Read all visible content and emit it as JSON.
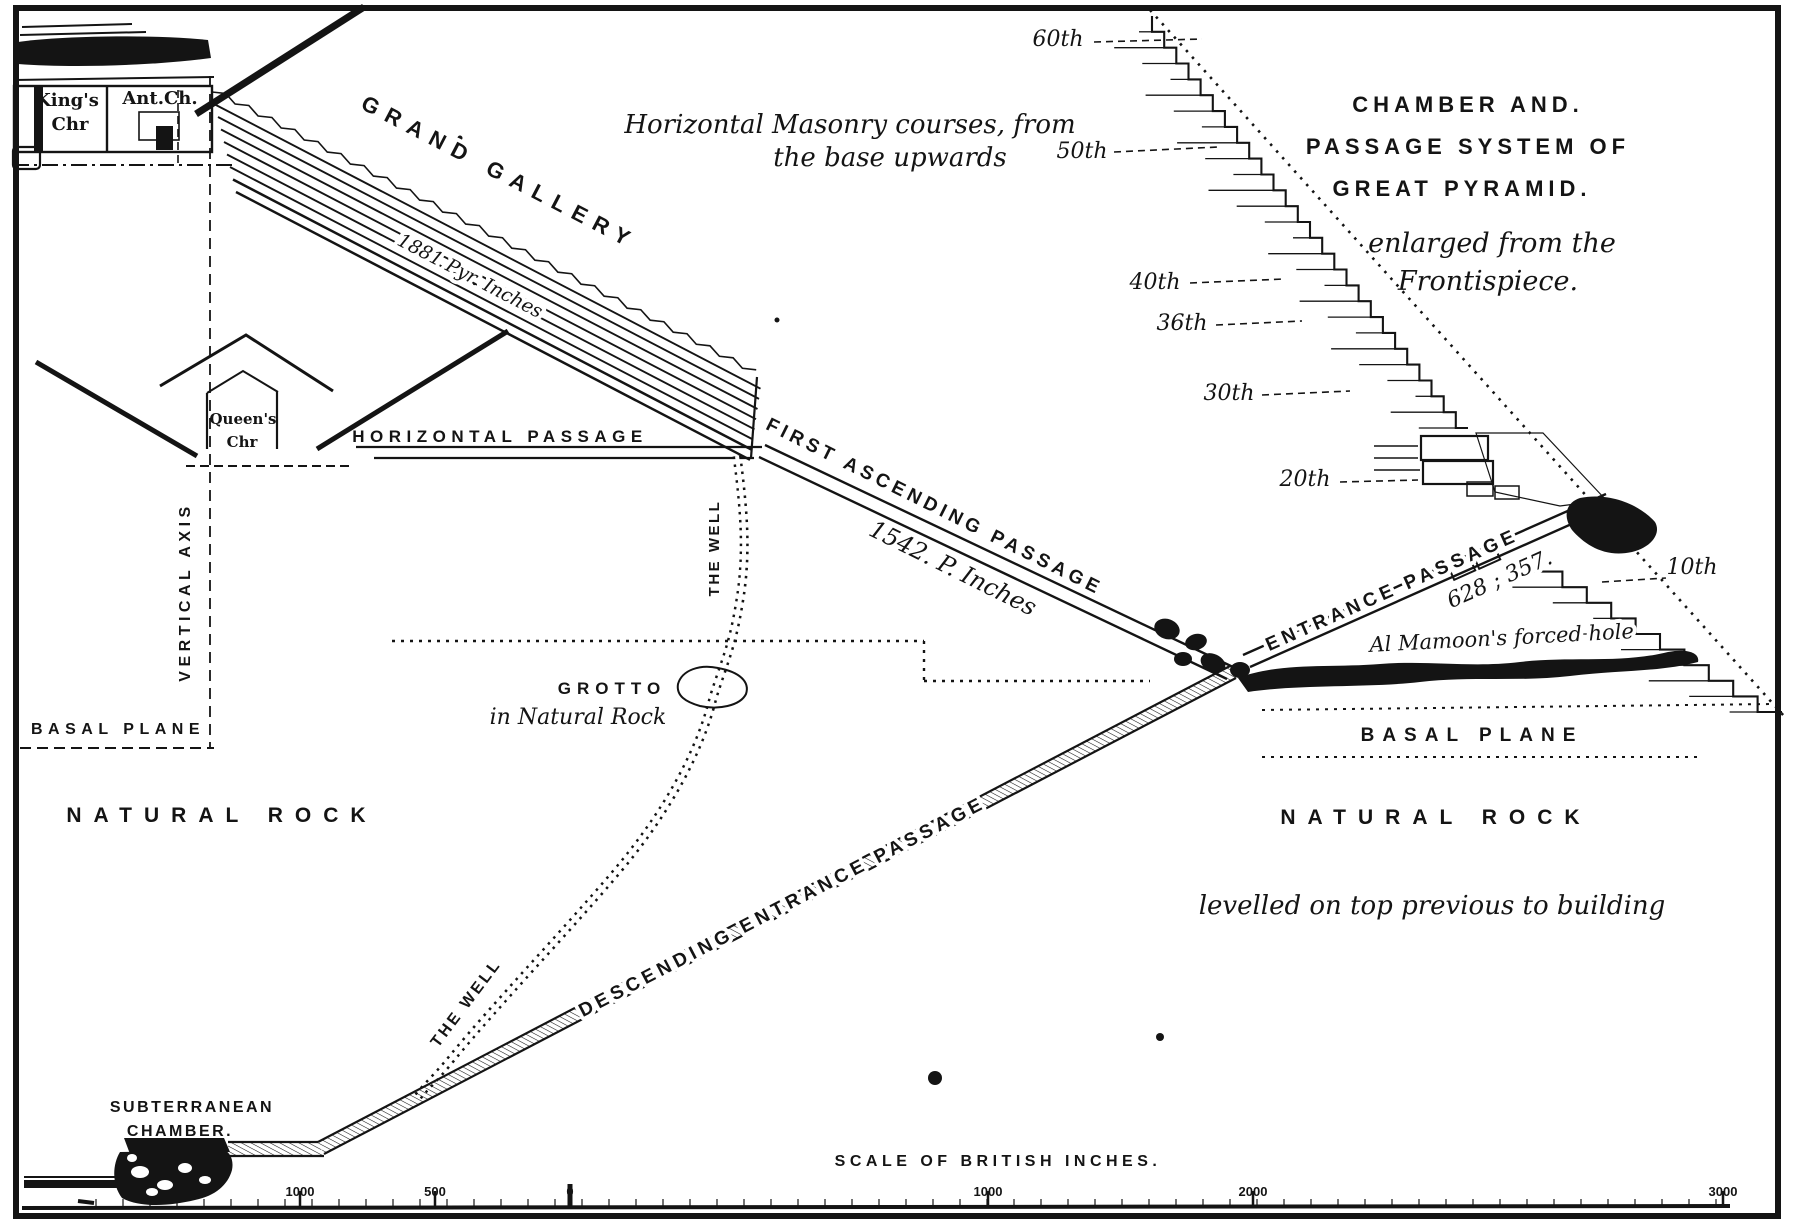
{
  "diagram": {
    "title": {
      "line1": "CHAMBER AND.",
      "line2": "PASSAGE SYSTEM OF",
      "line3": "GREAT PYRAMID.",
      "sub1": "enlarged from the",
      "sub2": "Frontispiece."
    },
    "masonry_note": {
      "line1": "Horizontal Masonry courses, from",
      "line2": "the base upwards"
    },
    "courses": [
      {
        "label": "60th"
      },
      {
        "label": "50th"
      },
      {
        "label": "40th"
      },
      {
        "label": "36th"
      },
      {
        "label": "30th"
      },
      {
        "label": "20th"
      },
      {
        "label": "10th"
      }
    ],
    "labels": {
      "grand_gallery": "GRAND GALLERY",
      "gallery_length": "1881 Pyr. Inches",
      "kings_chamber_1": "King's",
      "kings_chamber_2": "Chr",
      "ante_chamber": "Ant.Ch.",
      "queens_chamber_1": "Queen's",
      "queens_chamber_2": "Chr",
      "horizontal_passage": "HORIZONTAL PASSAGE",
      "vertical_axis": "VERTICAL AXIS",
      "basal_plane_left": "BASAL PLANE",
      "basal_plane_right": "BASAL PLANE",
      "natural_rock_left": "NATURAL ROCK",
      "natural_rock_right": "NATURAL ROCK",
      "first_ascending_passage": "FIRST ASCENDING PASSAGE",
      "ascending_length": "1542. P. Inches",
      "entrance_passage": "ENTRANCE PASSAGE",
      "entrance_numbers": "628 ; 357.",
      "al_mamoon": "Al Mamoon's forced hole",
      "the_well_upper": "THE WELL",
      "the_well_lower": "THE WELL",
      "grotto": "GROTTO",
      "grotto_sub": "in Natural Rock",
      "descending_passage": "DESCENDING ENTRANCE PASSAGE",
      "levelled_note": "levelled on top  previous to building",
      "subterranean_1": "SUBTERRANEAN",
      "subterranean_2": "CHAMBER."
    },
    "scale": {
      "title": "SCALE OF BRITISH INCHES.",
      "ticks": [
        {
          "label": "1000"
        },
        {
          "label": "500"
        },
        {
          "label": "0"
        },
        {
          "label": "1000"
        },
        {
          "label": "2000"
        },
        {
          "label": "3000"
        }
      ]
    }
  }
}
